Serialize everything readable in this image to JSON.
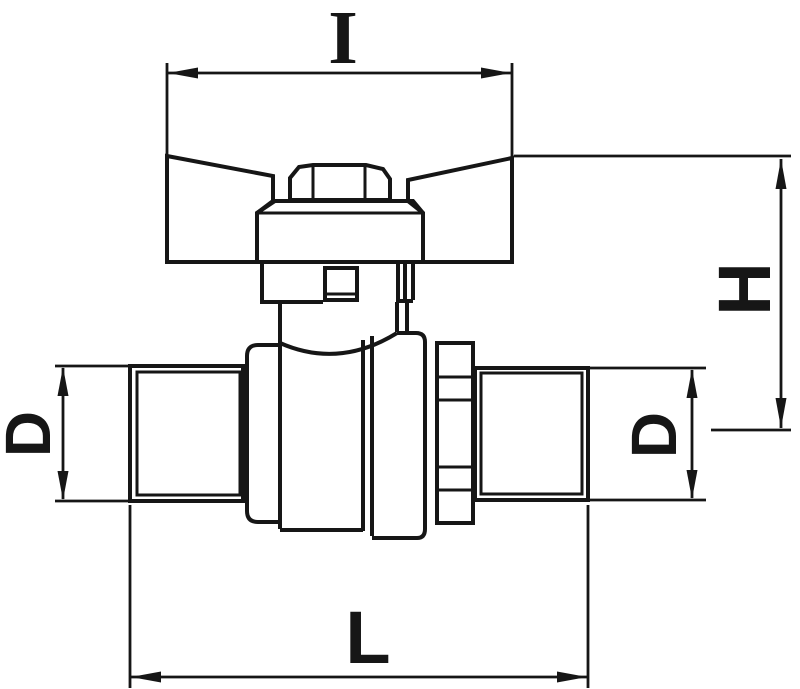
{
  "drawing": {
    "type": "technical-dimension-drawing",
    "subject": "ball valve with butterfly wing handle, side elevation",
    "background_color": "#ffffff",
    "line_color": "#161616",
    "dimensions": {
      "handle_width": {
        "label": "I",
        "position": "top",
        "orientation": "horizontal"
      },
      "overall_height": {
        "label": "H",
        "position": "right",
        "orientation": "vertical-rotated"
      },
      "left_thread_diameter": {
        "label": "D",
        "position": "left",
        "orientation": "vertical-rotated"
      },
      "right_thread_diameter": {
        "label": "D",
        "position": "right-of-body",
        "orientation": "vertical-rotated"
      },
      "overall_length": {
        "label": "L",
        "position": "bottom",
        "orientation": "horizontal"
      }
    }
  }
}
